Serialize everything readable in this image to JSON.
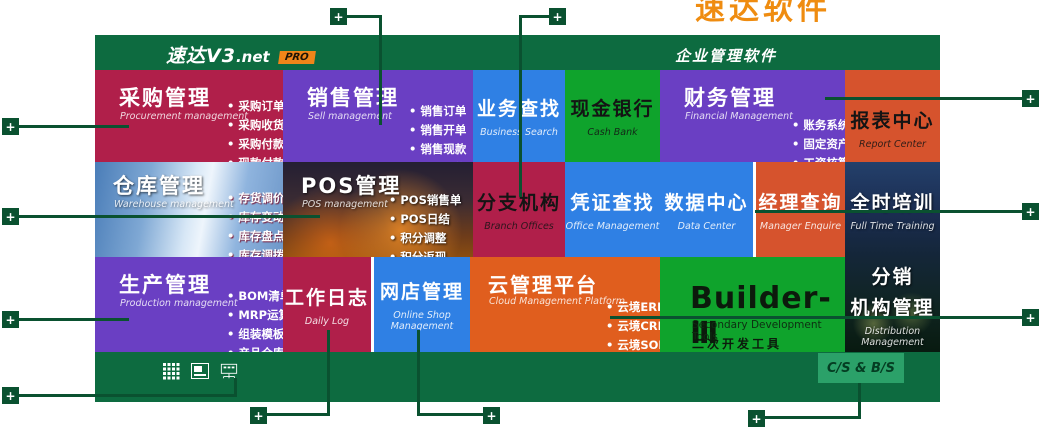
{
  "colors": {
    "panel_green": "#0d6b40",
    "annotation_green": "#0a5130",
    "crimson": "#b01f4a",
    "purple": "#6a3fc3",
    "blue": "#2f80e4",
    "green": "#0fa32c",
    "orange_red": "#d6532d",
    "orange": "#e05e1e",
    "badge_orange": "#f08519",
    "chip_green": "#2ba169",
    "banner_orange": "#ef8c10"
  },
  "header": {
    "logo_text": "速达V3",
    "logo_suffix": ".net",
    "badge": "PRO",
    "product_title": "企业管理软件",
    "clipped_banner": "速达软件"
  },
  "annotation": {
    "plus": "+"
  },
  "footer": {
    "cs_bs": "C/S & B/S",
    "icons": [
      "apps-grid-icon",
      "image-window-icon",
      "network-monitor-icon"
    ]
  },
  "tiles": {
    "procurement": {
      "title": "采购管理",
      "subtitle": "Procurement management",
      "bullets": [
        "采购订单",
        "采购收货",
        "采购付款",
        "现款付款"
      ]
    },
    "sales": {
      "title": "销售管理",
      "subtitle": "Sell management",
      "bullets": [
        "销售订单",
        "销售开单",
        "销售现款",
        "现款销售"
      ]
    },
    "business_search": {
      "title": "业务查找",
      "subtitle": "Business Search"
    },
    "cash_bank": {
      "title": "现金银行",
      "subtitle": "Cash Bank"
    },
    "finance": {
      "title": "财务管理",
      "subtitle": "Financial Management",
      "bullets": [
        "账务系统",
        "固定资产",
        "工资核算"
      ]
    },
    "report_center": {
      "title": "报表中心",
      "subtitle": "Report Center"
    },
    "warehouse": {
      "title": "仓库管理",
      "subtitle": "Warehouse management",
      "bullets": [
        "存货调价",
        "库存变动",
        "库存盘点",
        "库存调拨"
      ]
    },
    "pos": {
      "title": "POS管理",
      "subtitle": "POS management",
      "bullets": [
        "POS销售单",
        "POS日结",
        "积分调整",
        "积分返现"
      ]
    },
    "branch": {
      "title": "分支机构",
      "subtitle": "Branch Offices"
    },
    "voucher_search": {
      "title": "凭证查找",
      "subtitle": "Office Management"
    },
    "data_center": {
      "title": "数据中心",
      "subtitle": "Data Center"
    },
    "manager_enquiry": {
      "title": "经理查询",
      "subtitle": "Manager Enquire"
    },
    "training": {
      "title": "全时培训",
      "subtitle": "Full Time Training"
    },
    "production": {
      "title": "生产管理",
      "subtitle": "Production management",
      "bullets": [
        "BOM清单",
        "MRP运算",
        "组装模板",
        "产品仓库"
      ]
    },
    "daily_log": {
      "title": "工作日志",
      "subtitle": "Daily Log"
    },
    "online_shop": {
      "title": "网店管理",
      "subtitle": "Online Shop Management"
    },
    "cloud": {
      "title": "云管理平台",
      "subtitle": "Cloud Management Platform",
      "bullets": [
        "云境ERP",
        "云境CRM",
        "云境SOHO"
      ]
    },
    "builder": {
      "title": "Builder-Ⅲ",
      "subtitle_en": "Secondary Development Tools",
      "subtitle_cn": "二次开发工具"
    },
    "distribution": {
      "title_line1": "分销",
      "title_line2": "机构管理",
      "subtitle": "Distribution Management"
    }
  }
}
